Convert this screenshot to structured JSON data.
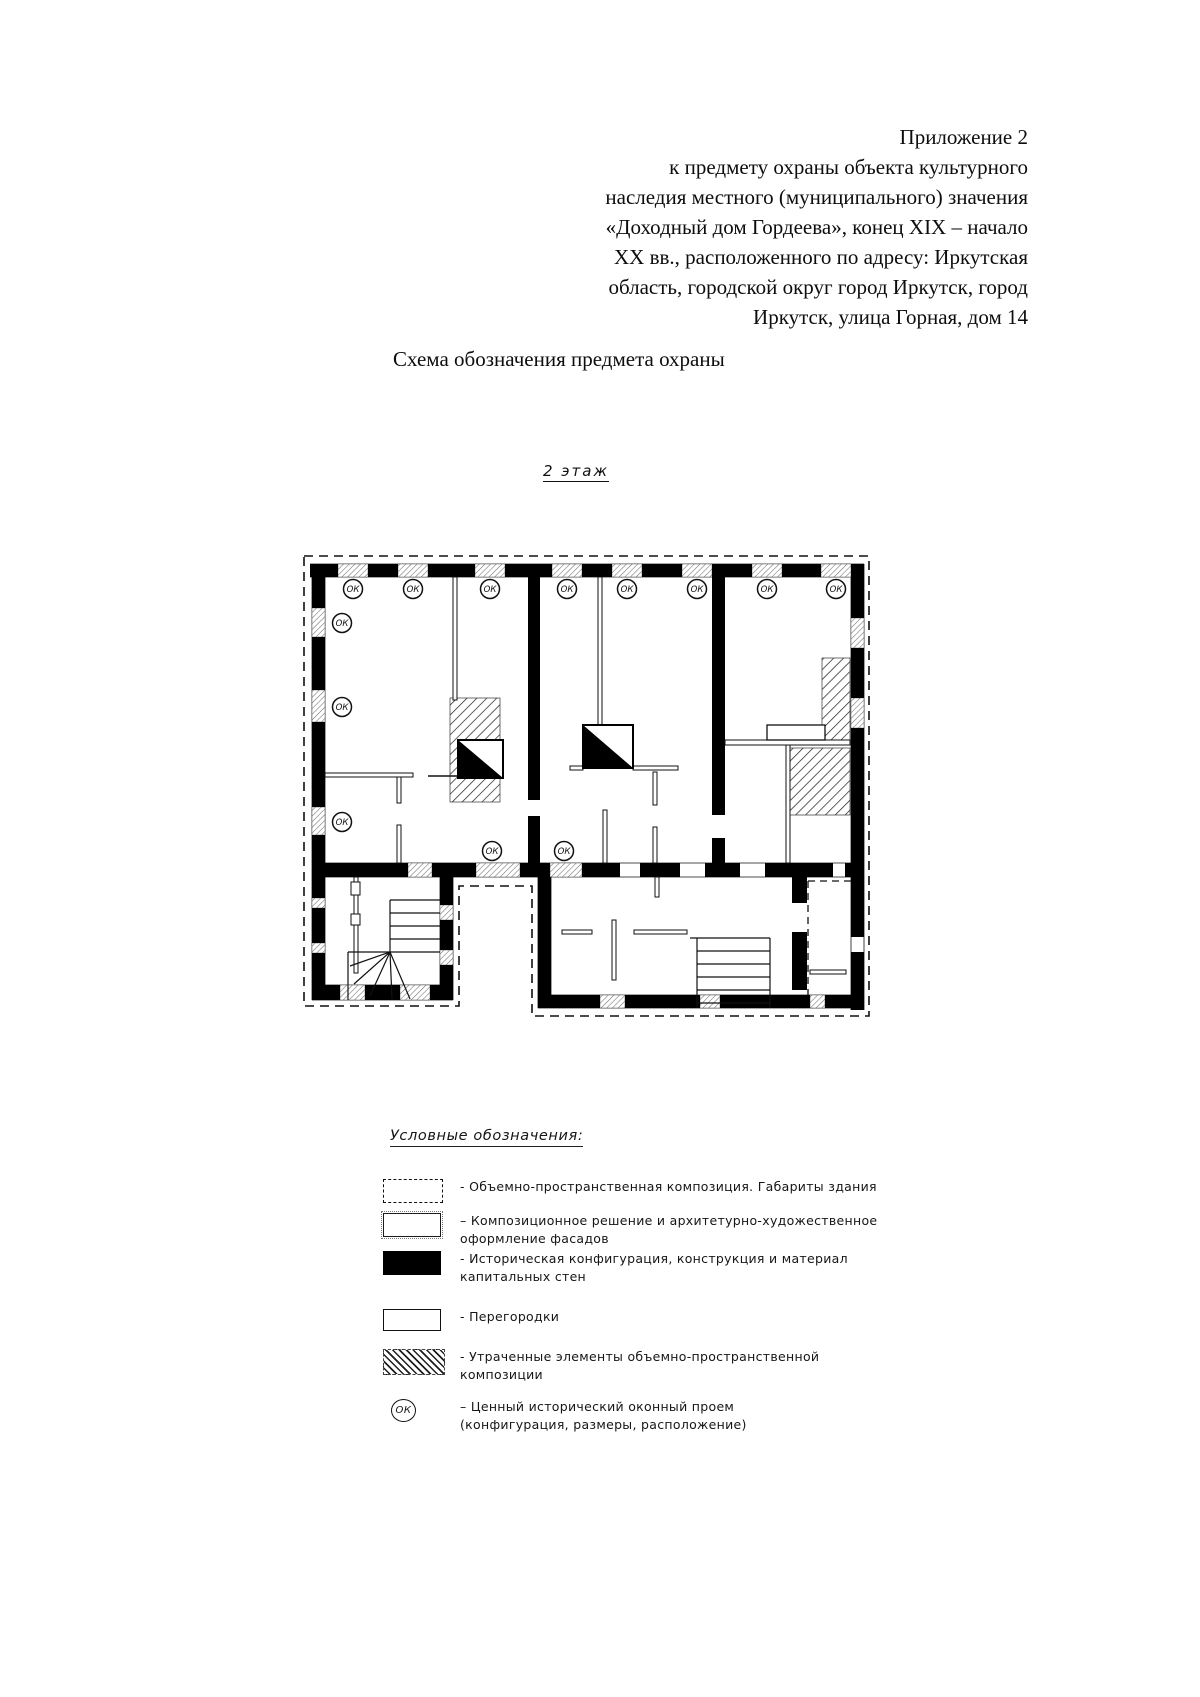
{
  "header": {
    "text": "Приложение 2\nк предмету охраны объекта культурного\nнаследия местного (муниципального) значения\n«Доходный дом Гордеева», конец XIX – начало\nXX вв., расположенного по адресу: Иркутская\nобласть, городской округ город Иркутск, город\nИркутск, улица Горная, дом 14"
  },
  "scheme_title": "Схема обозначения предмета охраны",
  "floor_label": "2 этаж",
  "plan": {
    "ok_label": "ОК"
  },
  "legend": {
    "title": "Условные обозначения:",
    "items": [
      {
        "symbol": "dashed-rect",
        "text": "- Объемно-пространственная композиция. Габариты здания"
      },
      {
        "symbol": "facade-rect",
        "text": "– Композиционное решение и архитетурно-художественное\nоформление фасадов"
      },
      {
        "symbol": "solid-rect",
        "text": "- Историческая конфигурация, конструкция и материал\nкапитальных стен"
      },
      {
        "symbol": "empty-rect",
        "text": "- Перегородки"
      },
      {
        "symbol": "hatched-rect",
        "text": "- Утраченные элементы объемно-пространственной\nкомпозиции"
      },
      {
        "symbol": "ok-circle",
        "symbol_label": "ОК",
        "text": "– Ценный исторический оконный проем\n(конфигурация, размеры, расположение)"
      }
    ]
  }
}
